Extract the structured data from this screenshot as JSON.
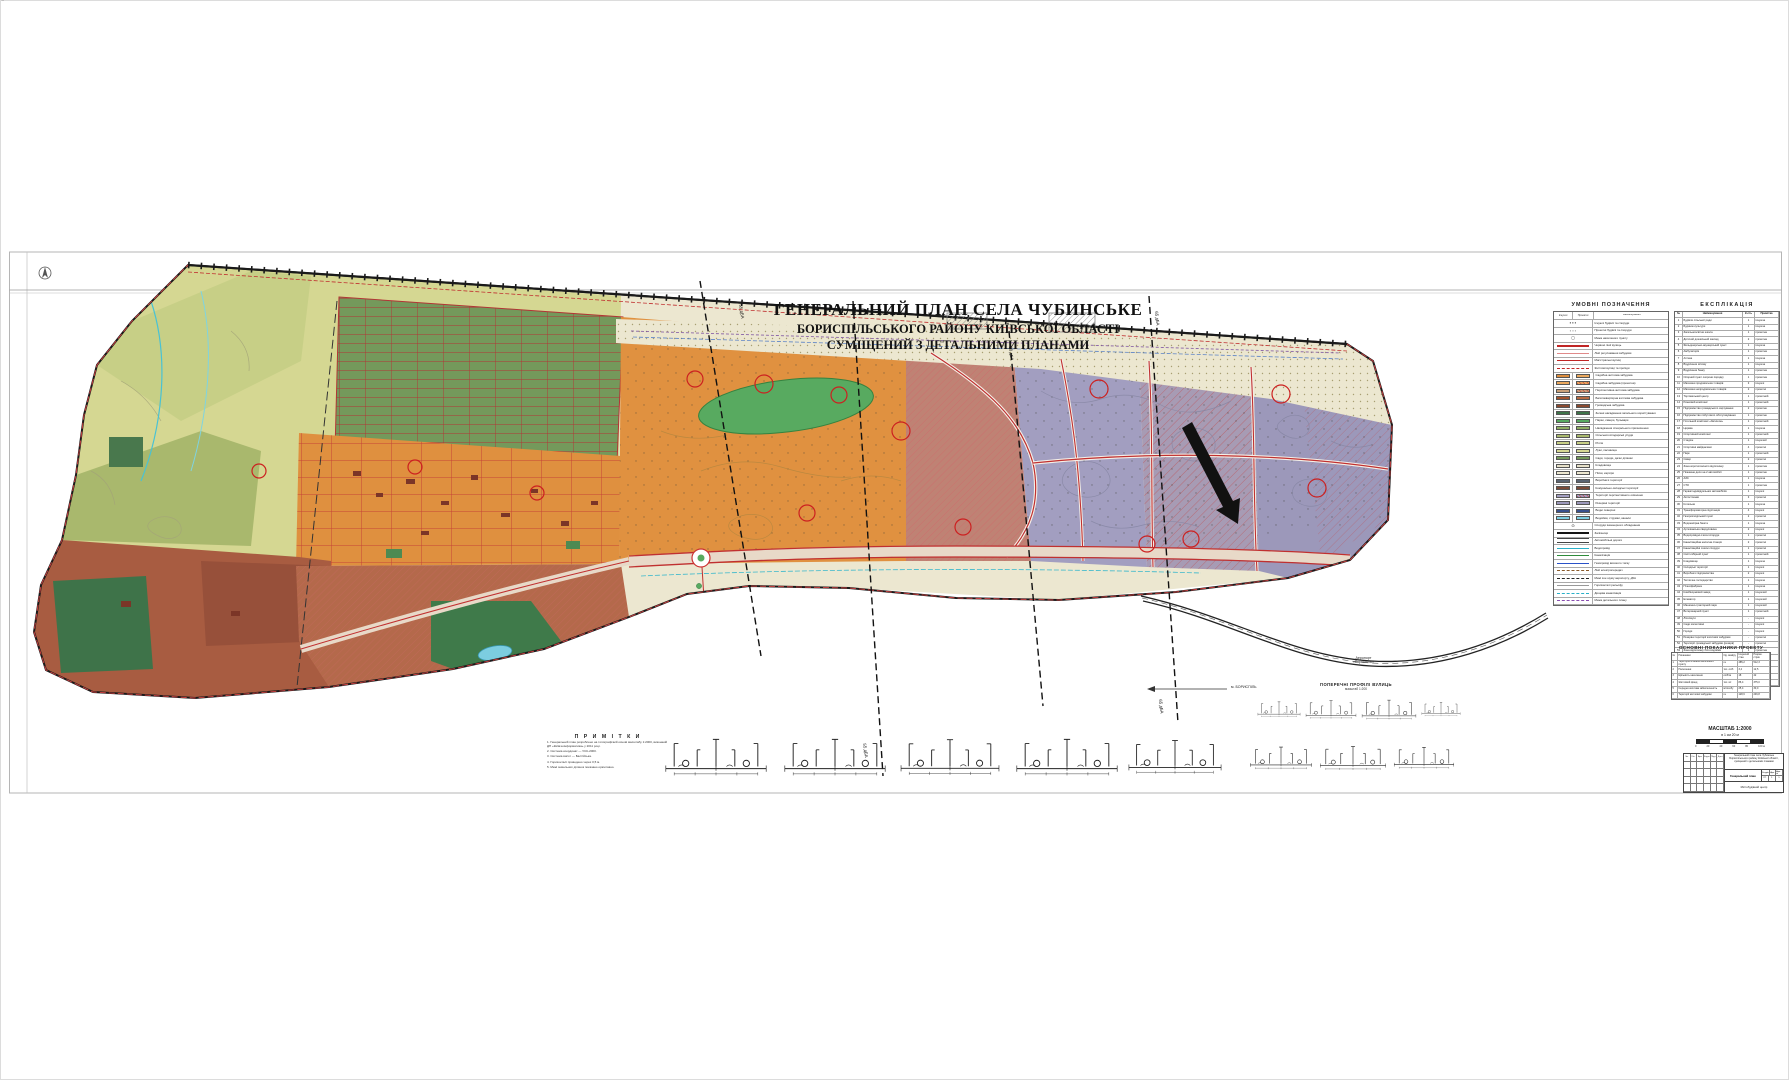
{
  "palette": {
    "yellow_fields": "#d5d792",
    "yellow_light": "#c7cf86",
    "olive": "#a9b86d",
    "orange_residential": "#df903f",
    "orange_east": "#e09140",
    "salmon_mixed": "#bf8274",
    "purple_perspective": "#a29ec0",
    "purple_east": "#9c98ba",
    "purple_mid": "#a79bb4",
    "brown_industrial": "#a85c41",
    "brown_south": "#b4694b",
    "green_park": "#3e7349",
    "allotment_green": "#74995b",
    "water": "#7ccde0",
    "road_red": "#c03030",
    "boundary_red": "#d04040",
    "park_ellipse": "#58aa60",
    "base_beige": "#ece7d0"
  },
  "document": {
    "title_line1": "ГЕНЕРАЛЬНИЙ ПЛАН СЕЛА ЧУБИНСЬКЕ",
    "title_line2": "БОРИСПІЛЬСЬКОГО РАЙОНУ КИЇВСЬКОЇ ОБЛАСТІ",
    "title_line3": "СУМІЩЕНИЙ З ДЕТАЛЬНИМИ ПЛАНАМИ"
  },
  "legend": {
    "title": "УМОВНІ ПОЗНАЧЕННЯ",
    "col1": "Існуючі",
    "col2": "Проектні",
    "col3": "Найменування",
    "rows": [
      {
        "type": "sym",
        "glyph": "▪ ▪ ▪",
        "label": "Існуючі будівлі та споруди"
      },
      {
        "type": "sym",
        "glyph": "▫ ▫ ▫",
        "label": "Проектні будівлі та споруди"
      },
      {
        "type": "sym",
        "glyph": "◻",
        "label": "Межа населеного пункту"
      },
      {
        "type": "ln",
        "style": "ln-redthick",
        "label": "Червоні лінії вулиць"
      },
      {
        "type": "ln",
        "style": "ln-pink",
        "label": "Лінії регулювання забудови"
      },
      {
        "type": "ln",
        "style": "ln-red",
        "label": "Магістральні вулиці"
      },
      {
        "type": "ln",
        "style": "ln-reddash",
        "label": "Житлові вулиці та проїзди"
      },
      {
        "type": "sw",
        "s1": "#dd8e3e",
        "s2": "#eaa85e",
        "label": "Садибна житлова забудова"
      },
      {
        "type": "sw",
        "s1": "#eaa85e",
        "s2": "#eaa85e",
        "h2": true,
        "label": "Садибна забудова (проектна)"
      },
      {
        "type": "sw",
        "s1": "#c9a078",
        "s2": "#c9a078",
        "h2": true,
        "label": "Перспективна житлова забудова"
      },
      {
        "type": "sw",
        "s1": "#a0522d",
        "s2": "#b86a42",
        "label": "Багатоквартирна житлова забудова"
      },
      {
        "type": "sw",
        "s1": "#8a4a30",
        "s2": "#8a4a30",
        "label": "Громадська забудова"
      },
      {
        "type": "sw",
        "s1": "#3e7349",
        "s2": "#3e7349",
        "label": "Зелені насадження загального користування"
      },
      {
        "type": "sw",
        "s1": "#58aa60",
        "s2": "#58aa60",
        "label": "Парки, сквери, бульвари"
      },
      {
        "type": "sw",
        "s1": "#8fae63",
        "s2": "#8fae63",
        "label": "Насадження спеціального призначення"
      },
      {
        "type": "sw",
        "s1": "#a9b86d",
        "s2": "#a9b86d",
        "label": "Сільськогосподарські угіддя"
      },
      {
        "type": "sw",
        "s1": "#c7cf86",
        "s2": "#c7cf86",
        "label": "Рілля"
      },
      {
        "type": "sw",
        "s1": "#d5d792",
        "s2": "#d5d792",
        "label": "Луки, пасовища"
      },
      {
        "type": "sw",
        "s1": "#74995b",
        "s2": "#74995b",
        "label": "Сади, городи, дачні ділянки"
      },
      {
        "type": "sw",
        "s1": "#e6e0c8",
        "s2": "#e6e0c8",
        "label": "Кладовища"
      },
      {
        "type": "sw",
        "s1": "#ece7d0",
        "s2": "#ece7d0",
        "label": "Піски, кар'єри"
      },
      {
        "type": "sw",
        "s1": "#5a6472",
        "s2": "#5a6472",
        "label": "Виробничі території"
      },
      {
        "type": "sw",
        "s1": "#7a4a38",
        "s2": "#7a4a38",
        "label": "Комунально-складські території"
      },
      {
        "type": "sw",
        "s1": "#a29ec0",
        "s2": "#a29ec0",
        "h2": true,
        "label": "Території перспективного освоєння"
      },
      {
        "type": "sw",
        "s1": "#9c98ba",
        "s2": "#9c98ba",
        "label": "Резервні території"
      },
      {
        "type": "sw",
        "s1": "#39518e",
        "s2": "#39518e",
        "label": "Водні поверхні"
      },
      {
        "type": "sw",
        "s1": "#7ccde0",
        "s2": "#7ccde0",
        "label": "Водойми, струмки, канали"
      },
      {
        "type": "sym",
        "glyph": "⊙",
        "label": "Споруди інженерного обладнання"
      },
      {
        "type": "ln",
        "style": "ln-rail",
        "label": "Залізниця"
      },
      {
        "type": "ln",
        "style": "ln-double",
        "label": "Автомобільні дороги"
      },
      {
        "type": "ln",
        "style": "ln-cyan",
        "label": "Водопровід"
      },
      {
        "type": "ln",
        "style": "ln-green",
        "label": "Каналізація"
      },
      {
        "type": "ln",
        "style": "ln-blue",
        "label": "Газопровід високого тиску"
      },
      {
        "type": "ln",
        "style": "ln-browndash",
        "label": "Лінії електропередач"
      },
      {
        "type": "ln",
        "style": "ln-blackdash",
        "label": "Межі зон шуму аеропорту, дБА"
      },
      {
        "type": "ln",
        "style": "ln-gray",
        "label": "Горизонталі рельєфу"
      },
      {
        "type": "ln",
        "style": "ln-cyandash",
        "label": "Дощова каналізація"
      },
      {
        "type": "ln",
        "style": "ln-purple",
        "label": "Межа детального плану"
      }
    ]
  },
  "explication": {
    "title": "ЕКСПЛІКАЦІЯ",
    "headers": [
      "№",
      "Найменування",
      "К-сть",
      "Примітка"
    ],
    "rows": [
      [
        "1",
        "Будівля сільської ради",
        "1",
        "існуюча"
      ],
      [
        "2",
        "Будинок культури",
        "1",
        "існуюча"
      ],
      [
        "3",
        "Загальноосвітня школа",
        "1",
        "проектна"
      ],
      [
        "4",
        "Дитячий дошкільний заклад",
        "2",
        "проектна"
      ],
      [
        "5",
        "Фельдшерсько-акушерський пункт",
        "1",
        "існуюча"
      ],
      [
        "6",
        "Амбулаторія",
        "1",
        "проектна"
      ],
      [
        "7",
        "Аптека",
        "1",
        "існуюча"
      ],
      [
        "8",
        "Відділення зв'язку",
        "1",
        "існуюча"
      ],
      [
        "9",
        "Відділення банку",
        "1",
        "проектна"
      ],
      [
        "10",
        "Опорний пункт охорони порядку",
        "1",
        "проектна"
      ],
      [
        "11",
        "Магазини продовольчих товарів",
        "3",
        "існуючі"
      ],
      [
        "12",
        "Магазини непродовольчих товарів",
        "2",
        "проектні"
      ],
      [
        "13",
        "Торговельний центр",
        "1",
        "проектний"
      ],
      [
        "14",
        "Ринковий комплекс",
        "1",
        "проектний"
      ],
      [
        "15",
        "Підприємство громадського харчування",
        "2",
        "проектне"
      ],
      [
        "16",
        "Підприємство побутового обслуговування",
        "1",
        "проектне"
      ],
      [
        "17",
        "Готельний комплекс «Затишок»",
        "1",
        "проектний"
      ],
      [
        "18",
        "Церква",
        "1",
        "існуюча"
      ],
      [
        "19",
        "Спортивний комплекс",
        "1",
        "проектний"
      ],
      [
        "20",
        "Стадіон",
        "1",
        "існуючий"
      ],
      [
        "21",
        "Спортивні майданчики",
        "4",
        "проектні"
      ],
      [
        "22",
        "Парк",
        "1",
        "проектний"
      ],
      [
        "23",
        "Сквер",
        "2",
        "проектні"
      ],
      [
        "24",
        "Зона короткочасного відпочинку",
        "1",
        "проектна"
      ],
      [
        "25",
        "Пожежне депо на 2 автомобілі",
        "1",
        "проектне"
      ],
      [
        "26",
        "АЗС",
        "1",
        "існуюча"
      ],
      [
        "27",
        "СТО",
        "1",
        "проектна"
      ],
      [
        "28",
        "Гаражі індивідуальних автомобілів",
        "1",
        "існуючі"
      ],
      [
        "29",
        "Автостоянки",
        "3",
        "проектні"
      ],
      [
        "30",
        "Котельня",
        "1",
        "існуюча"
      ],
      [
        "31",
        "Трансформаторна підстанція",
        "4",
        "існуючі"
      ],
      [
        "32",
        "Газорозподільний пункт",
        "2",
        "проектні"
      ],
      [
        "33",
        "Водонапірна башта",
        "1",
        "існуюча"
      ],
      [
        "34",
        "Артезіанська свердловина",
        "2",
        "існуючі"
      ],
      [
        "35",
        "Водопровідні очисні споруди",
        "1",
        "проектні"
      ],
      [
        "36",
        "Каналізаційна насосна станція",
        "2",
        "проектні"
      ],
      [
        "37",
        "Каналізаційні очисні споруди",
        "1",
        "проектні"
      ],
      [
        "38",
        "Сміттєзбірний пункт",
        "1",
        "проектний"
      ],
      [
        "39",
        "Кладовище",
        "1",
        "існуюче"
      ],
      [
        "40",
        "Складські території",
        "1",
        "існуючі"
      ],
      [
        "41",
        "Виробничі підприємства",
        "2",
        "існуючі"
      ],
      [
        "42",
        "Тепличне господарство",
        "1",
        "існуюче"
      ],
      [
        "43",
        "Птахофабрика",
        "1",
        "існуюча"
      ],
      [
        "44",
        "Комбікормовий завод",
        "1",
        "існуючий"
      ],
      [
        "45",
        "Елеватор",
        "1",
        "існуючий"
      ],
      [
        "46",
        "Машинно-тракторний парк",
        "1",
        "існуючий"
      ],
      [
        "47",
        "Ветеринарний пункт",
        "1",
        "проектний"
      ],
      [
        "48",
        "Лісосмуги",
        "-",
        "існуючі"
      ],
      [
        "49",
        "Сади колективні",
        "-",
        "існуючі"
      ],
      [
        "50",
        "Городи",
        "-",
        "існуючі"
      ],
      [
        "51",
        "Резервні території житлової забудови",
        "-",
        "проектні"
      ],
      [
        "52",
        "Території громадської забудови (резерв)",
        "-",
        "проектні"
      ],
      [
        "53",
        "Зона відпочинку біля водойми",
        "1",
        "проектна"
      ],
      [
        "54",
        "Дитячі ігрові майданчики",
        "5",
        "проектні"
      ],
      [
        "55",
        "Адміністративно-побутовий корпус",
        "1",
        "існуючий"
      ],
      [
        "56",
        "Цех переробки с/г продукції",
        "1",
        "проектний"
      ],
      [
        "57",
        "Очисні споруди дощової каналізації",
        "1",
        "проектні"
      ],
      [
        "58",
        "Електропідстанція",
        "1",
        "існуюча"
      ]
    ]
  },
  "indicators": {
    "title": "ОСНОВНІ ПОКАЗНИКИ ПРОЕКТУ",
    "headers": [
      "№",
      "Показники",
      "Од. виміру",
      "Існуючий стан",
      "Розрах. строк"
    ],
    "rows": [
      [
        "1",
        "Територія в межах населеного пункту",
        "га",
        "485,2",
        "512,3"
      ],
      [
        "2",
        "Населення",
        "тис. осіб",
        "3,4",
        "12,5"
      ],
      [
        "3",
        "Щільність населення",
        "осіб/га",
        "18",
        "42"
      ],
      [
        "4",
        "Житловий фонд",
        "тис. м²",
        "86,4",
        "375,0"
      ],
      [
        "5",
        "Середня житлова забезпеченість",
        "м²/особу",
        "25,4",
        "30,0"
      ],
      [
        "6",
        "Території житлової забудови",
        "га",
        "128,6",
        "246,8"
      ]
    ]
  },
  "scale": {
    "title": "МАСШТАБ 1:2000",
    "subtitle": "в 1 см 20 м",
    "ticks": [
      "0",
      "20",
      "40",
      "60",
      "80",
      "100 м"
    ]
  },
  "notes": {
    "title": "П Р И М І Т К И",
    "lines": [
      "1. Генеральний план розроблено на топографічній основі масштабу 1:2000, виконаній ДП «Київгеоінформатика» у 2011 році.",
      "2. Система координат — УСК-2000.",
      "3. Система висот — Балтійська.",
      "4. Горизонталі проведено через 0,5 м.",
      "5. Межі земельних ділянок показано орієнтовно."
    ]
  },
  "profiles": {
    "title": "ПОПЕРЕЧНІ ПРОФІЛІ ВУЛИЦЬ",
    "subtitle": "масштаб 1:200"
  },
  "noise_labels": {
    "a": "55 дБА",
    "b": "60 дБА",
    "c": "65 дБА",
    "d": "55 дБА",
    "e": "65 дБА"
  },
  "map_labels": {
    "airport1": "Аеропорт",
    "airport2": "«Бориспіль»",
    "direction": "м. БОРИСПІЛЬ"
  },
  "stamp": {
    "cols": [
      "Зм.",
      "Кіл.",
      "Арк.",
      "№док.",
      "Підп.",
      "Дата"
    ],
    "project": "Генеральний план села Чубинське Бориспільського району Київської області, суміщений з детальними планами",
    "sheet_name": "Генеральний план",
    "stage_label": "Стадія",
    "stage": "ГП",
    "sheet_label": "Арк.",
    "sheet": "1",
    "sheets_label": "Арк-ів",
    "sheets": "1",
    "org": "Містобудівний центр"
  },
  "margin_text": "Інв. № ориг.      Підпис і дата      Зам. інв. №"
}
